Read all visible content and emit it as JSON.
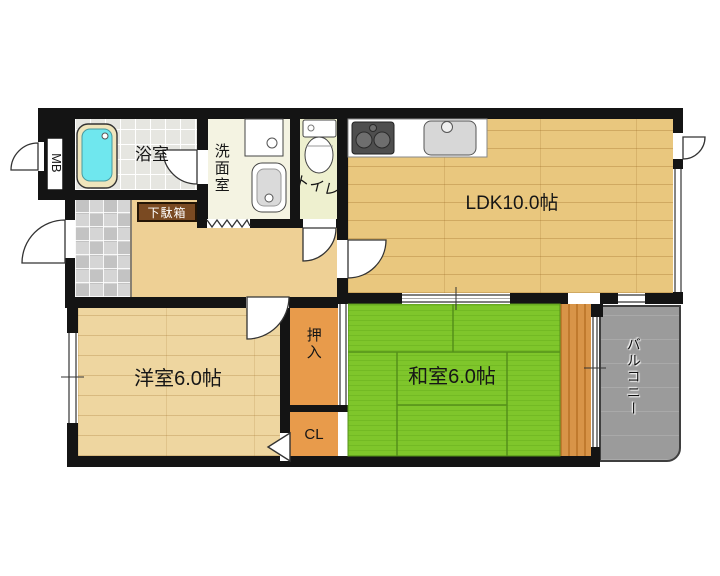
{
  "rooms": {
    "ldk": {
      "label": "LDK10.0帖"
    },
    "western": {
      "label": "洋室6.0帖"
    },
    "japanese": {
      "label": "和室6.0帖"
    },
    "bath": {
      "label": "浴室"
    },
    "washroom": {
      "label": "洗面室"
    },
    "toilet": {
      "label": "トイレ"
    },
    "balcony": {
      "label": "バルコニー"
    },
    "oshiire": {
      "label": "押入"
    },
    "cl": {
      "label": "CL"
    },
    "shoe_cabinet": {
      "label": "下駄箱"
    },
    "meter_box": {
      "label": "MB"
    }
  },
  "icons": {
    "bathtub": "bathtub-icon",
    "washing_machine": "washing-machine-icon",
    "vanity": "vanity-sink-icon",
    "toilet_bowl": "toilet-icon",
    "gas_stove": "gas-stove-icon",
    "kitchen_sink": "kitchen-sink-icon",
    "door_swing": "door-swing-icon",
    "sliding_window": "window-icon",
    "accordion_door": "accordion-door-icon",
    "folding_door": "folding-door-icon"
  },
  "colors": {
    "wall": "#141414",
    "tatami_green": "#7fc62b",
    "flooring_tan": "#e9c77e",
    "closet_orange": "#e89b4b",
    "balcony_gray": "#9b9b9b",
    "bathtub_cyan": "#6fe7ee",
    "shoe_cabinet_brown": "#7a4a22"
  }
}
